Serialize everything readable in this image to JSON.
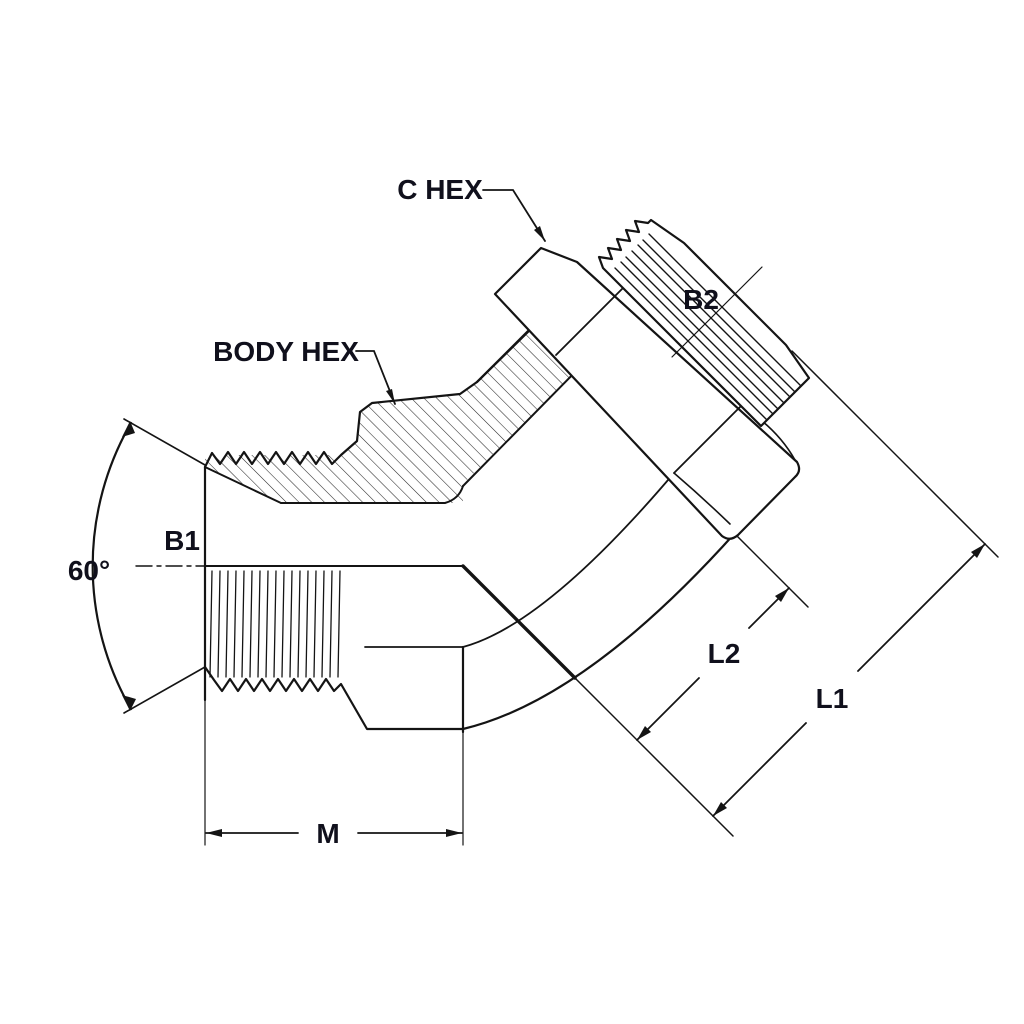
{
  "diagram": {
    "type": "technical-drawing",
    "subject": "45-degree male adjustable elbow hydraulic fitting, half-section view",
    "stroke_color": "#141414",
    "background": "#ffffff",
    "labels": {
      "c_hex": "C HEX",
      "body_hex": "BODY HEX",
      "b1": "B1",
      "b2": "B2",
      "angle": "60°",
      "l1": "L1",
      "l2": "L2",
      "m": "M"
    },
    "dimensions": [
      {
        "name": "60°",
        "meaning": "included angle of internal cone seat on left male port"
      },
      {
        "name": "M",
        "meaning": "length of left male port from face to body end"
      },
      {
        "name": "L2",
        "meaning": "length along 45° arm from elbow corner to C-hex near face"
      },
      {
        "name": "L1",
        "meaning": "overall length along 45° arm from elbow corner to thread tip"
      },
      {
        "name": "B1",
        "meaning": "thread size of left male port"
      },
      {
        "name": "B2",
        "meaning": "thread size of upper 45° male thread"
      }
    ],
    "callouts": [
      {
        "name": "C HEX",
        "points_to": "locknut hex on 45° arm"
      },
      {
        "name": "BODY HEX",
        "points_to": "hex on fitting body"
      }
    ]
  }
}
